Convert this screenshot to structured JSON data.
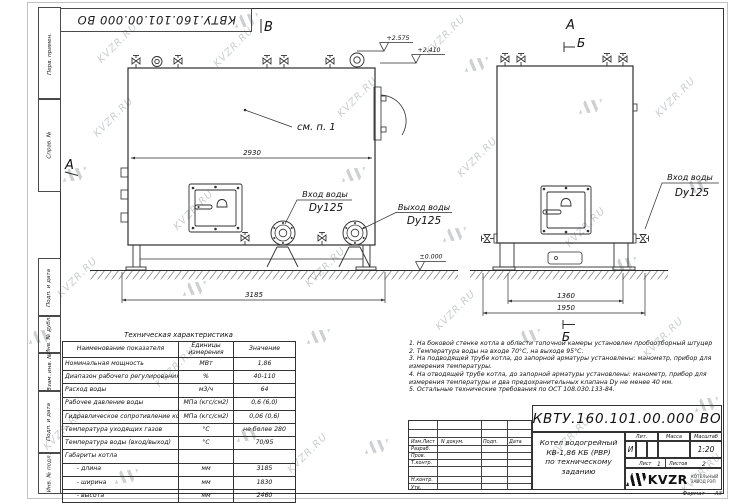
{
  "watermark": {
    "text": "KVZR.RU"
  },
  "frame": {
    "designation_top": "КВТУ.160.101.00.000 ВО",
    "side_labels": [
      "Перв. примен.",
      "Справ. №",
      "Подп. и дата",
      "Инв. № дубл.",
      "Взам. инв. №",
      "Подп. и дата",
      "Инв. № подл."
    ]
  },
  "views": {
    "front": {
      "label_b": "В",
      "label_a": "А",
      "elev1": "+2.575",
      "elev2": "+2.410",
      "see_note": "см. п. 1",
      "dim_width": "2930",
      "dim_length": "3185",
      "inlet_title": "Вход воды",
      "inlet_dn": "Dy125",
      "outlet_title": "Выход воды",
      "outlet_dn": "Dy125",
      "elev_zero": "±0.000"
    },
    "side": {
      "label_a": "А",
      "label_b_top": "Б",
      "label_b_bottom": "Б",
      "dim_inner": "1360",
      "dim_outer": "1950",
      "inlet_title": "Вход воды",
      "inlet_dn": "Dy125"
    }
  },
  "spec_table": {
    "title": "Техническая характеристика",
    "headers": [
      "Наименование показателя",
      "Единицы измерения",
      "Значение"
    ],
    "rows": [
      {
        "name": "Номинальная мощность",
        "unit": "МВт",
        "value": "1,86"
      },
      {
        "name": "Диапазон рабочего регулирования",
        "unit": "%",
        "value": "40-110"
      },
      {
        "name": "Расход воды",
        "unit": "м3/ч",
        "value": "64"
      },
      {
        "name": "Рабочее давление воды",
        "unit": "МПа (кгс/см2)",
        "value": "0,6 (6,0)"
      },
      {
        "name": "Гидравлическое сопротивление котла",
        "unit": "МПа (кгс/см2)",
        "value": "0,06 (0,6)"
      },
      {
        "name": "Температура уходящих газов",
        "unit": "°С",
        "value": "не более 280"
      },
      {
        "name": "Температура воды (вход/выход)",
        "unit": "°С",
        "value": "70/95"
      },
      {
        "name": "Габариты котла",
        "unit": "",
        "value": ""
      },
      {
        "name": "      - длина",
        "unit": "мм",
        "value": "3185"
      },
      {
        "name": "      - ширина",
        "unit": "мм",
        "value": "1830"
      },
      {
        "name": "      - высота",
        "unit": "мм",
        "value": "2460"
      }
    ]
  },
  "notes": {
    "lines": [
      "1. На боковой стенке котла в области топочной камеры установлен пробоотборный штуцер",
      "2.  Температура воды на входе 70°С, на выходе 95°С.",
      "3. На подводящей трубе котла, до запорной арматуры установлены: манометр, прибор для",
      "измерения температуры.",
      "4. На отводящей трубе котла, до запорной арматуры установлены: манометр, прибор для",
      "измерения температуры и два предохранительных клапана Dу не менее 40 мм.",
      "5. Остальные технические требования по ОСТ 108.030.133-84."
    ]
  },
  "title_block": {
    "designation": "КВТУ.160.101.00.000 ВО",
    "doc_name_line1": "Котел водогрейный",
    "doc_name_line2": "КВ-1,86 КБ (РВР)",
    "doc_name_line3": "по техническому заданию",
    "h_izm": "Изм.Лист",
    "h_doc": "N докум.",
    "h_sign": "Подп.",
    "h_date": "Дата",
    "sig_rows": [
      "Разраб.",
      "Пров.",
      "Т.контр.",
      "Н.контр.",
      "Утв."
    ],
    "lit_label": "Лит.",
    "mass_label": "Масса",
    "scale_label": "Масштаб",
    "lit_value": "И",
    "scale_value": "1:20",
    "sheet_label": "Лист",
    "sheet_value": "1",
    "sheets_label": "Листов",
    "sheets_value": "2",
    "company": "KVZR",
    "company_sub1": "КОТЕЛЬНЫЙ",
    "company_sub2": "ЗАВОД РЭП",
    "format_label": "Формат",
    "format_value": "А3"
  }
}
